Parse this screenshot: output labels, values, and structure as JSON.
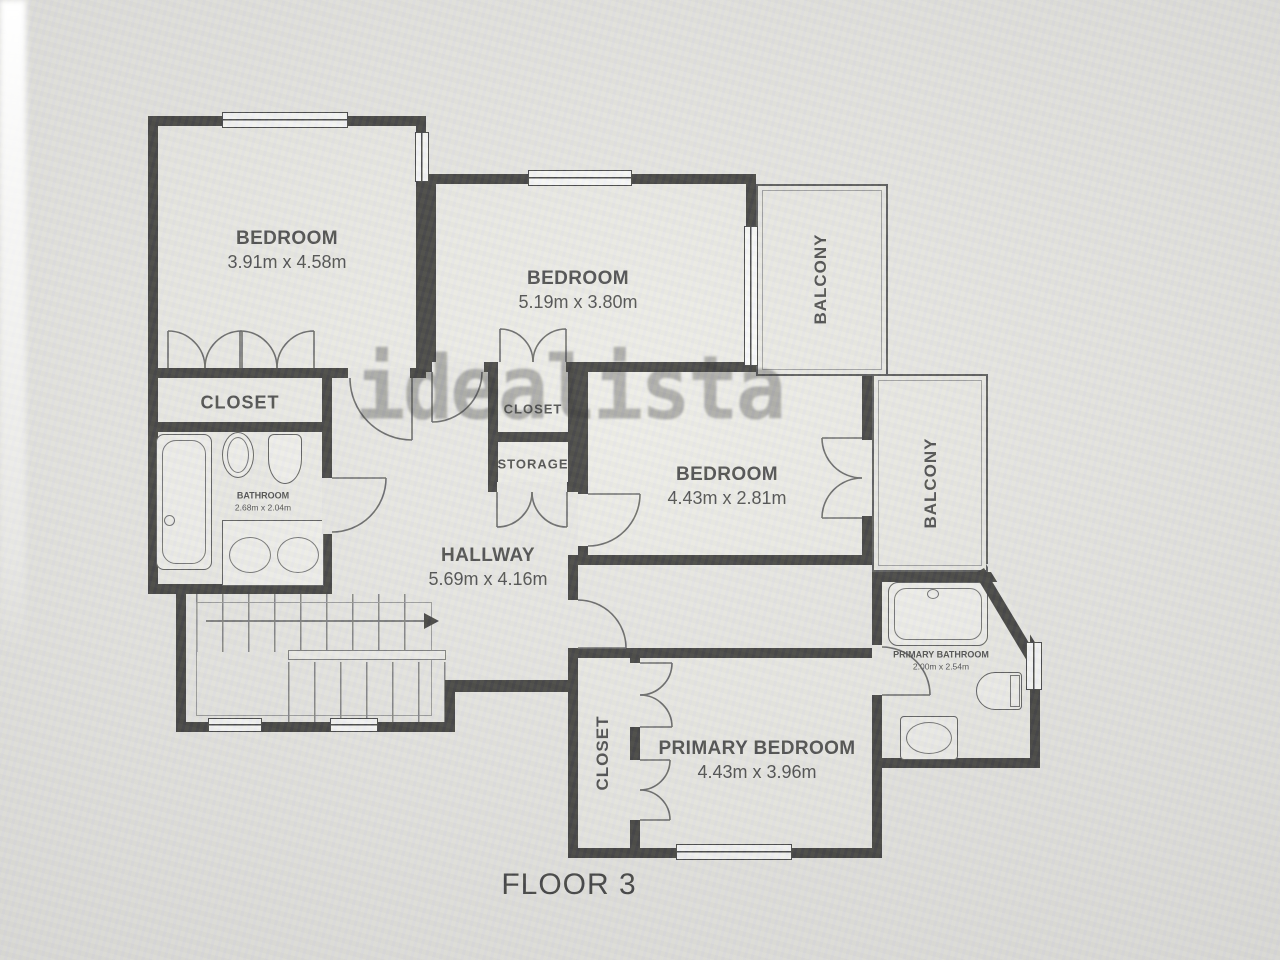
{
  "watermark": "idealista",
  "floor_label": "FLOOR 3",
  "rooms": {
    "bedroom1": {
      "name": "BEDROOM",
      "dims": "3.91m x 4.58m"
    },
    "bedroom2": {
      "name": "BEDROOM",
      "dims": "5.19m x 3.80m"
    },
    "bedroom3": {
      "name": "BEDROOM",
      "dims": "4.43m x 2.81m"
    },
    "primary_bedroom": {
      "name": "PRIMARY BEDROOM",
      "dims": "4.43m x 3.96m"
    },
    "hallway": {
      "name": "HALLWAY",
      "dims": "5.69m x 4.16m"
    },
    "bathroom": {
      "name": "BATHROOM",
      "dims": "2.68m x 2.04m"
    },
    "primary_bathroom": {
      "name": "PRIMARY BATHROOM",
      "dims": "2.00m x 2.54m"
    },
    "closet1": {
      "name": "CLOSET"
    },
    "closet_mid": {
      "name": "CLOSET"
    },
    "storage": {
      "name": "STORAGE"
    },
    "closet_primary": {
      "name": "CLOSET"
    },
    "balcony_top": {
      "name": "BALCONY"
    },
    "balcony_right": {
      "name": "BALCONY"
    }
  },
  "colors": {
    "wall": "#1d1c1a",
    "line": "#4c4c4c",
    "background": "#e9e8e4",
    "watermark_gray": "#a9a9a9",
    "text": "#2b2b2b"
  }
}
